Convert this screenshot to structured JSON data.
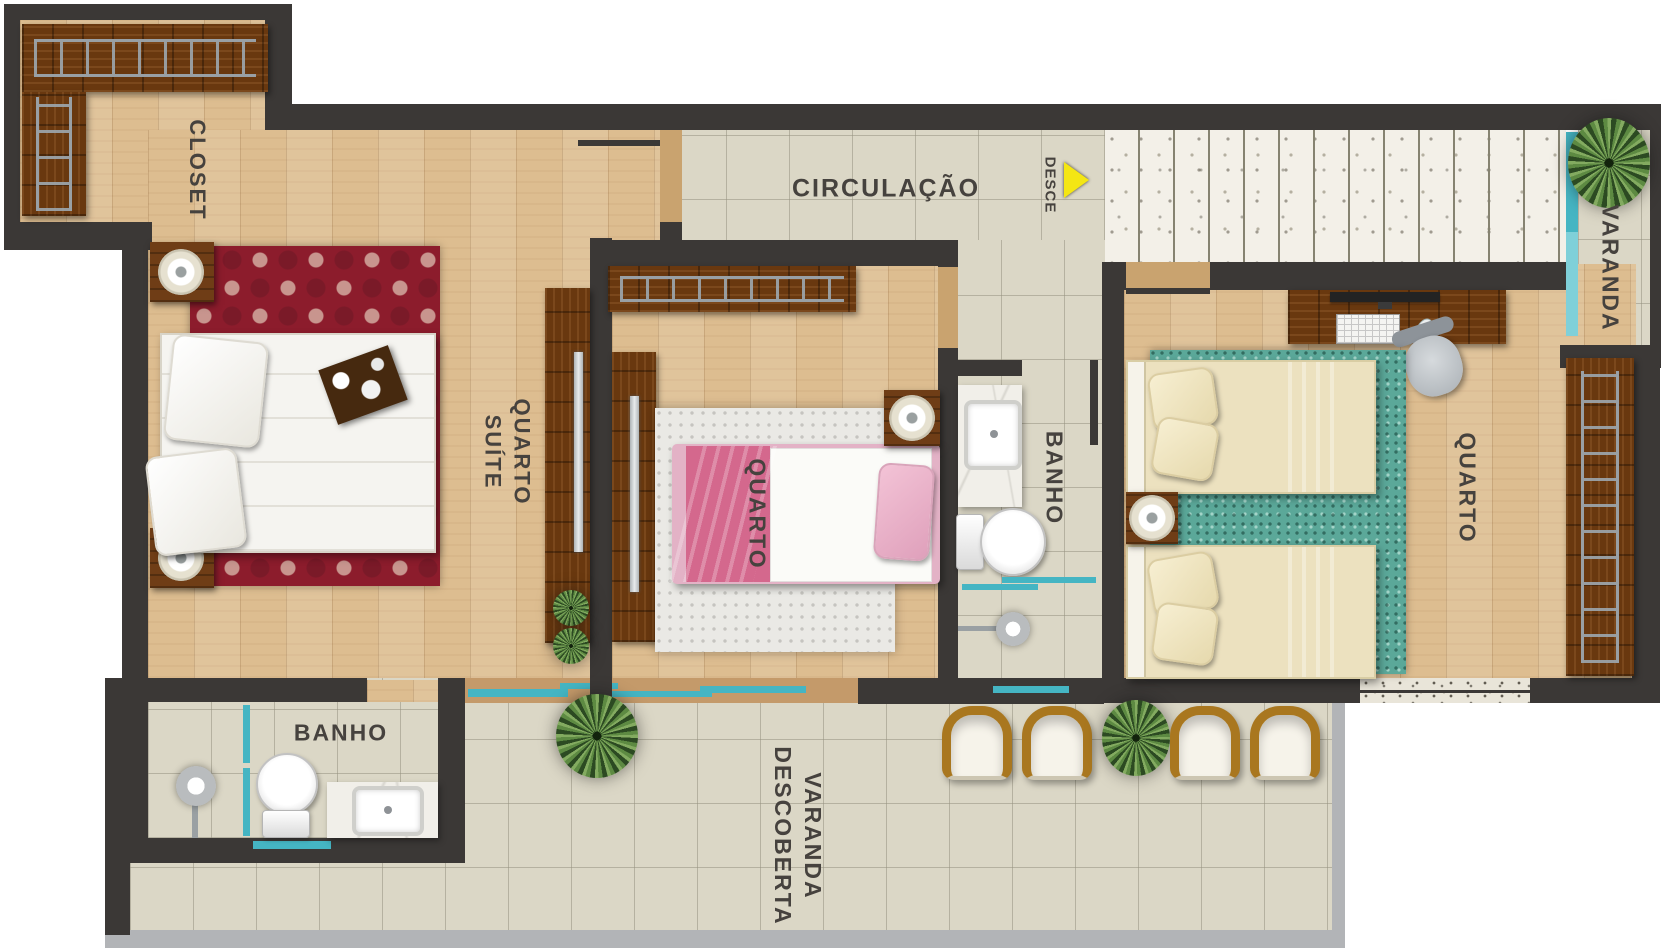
{
  "labels": {
    "closet": "CLOSET",
    "circulacao": "CIRCULAÇÃO",
    "desce": "DESCE",
    "varanda": "VARANDA",
    "quarto_suite_l1": "QUARTO",
    "quarto_suite_l2": "SUÍTE",
    "quarto_middle": "QUARTO",
    "banho_middle": "BANHO",
    "quarto_right": "QUARTO",
    "banho_left": "BANHO",
    "varanda_descoberta_l1": "VARANDA",
    "varanda_descoberta_l2": "DESCOBERTA"
  },
  "colors": {
    "wall": "#3b3836",
    "wood_floor": "#ddbd90",
    "tile_floor": "#dbd7c6",
    "window_glass": "#45b5c3",
    "stair_tread": "#f3f0e8",
    "rug_suite": "#8c1c2c",
    "rug_twin_room": "#5ba899",
    "label_text": "#46423e",
    "desce_arrow": "#f4e613"
  }
}
